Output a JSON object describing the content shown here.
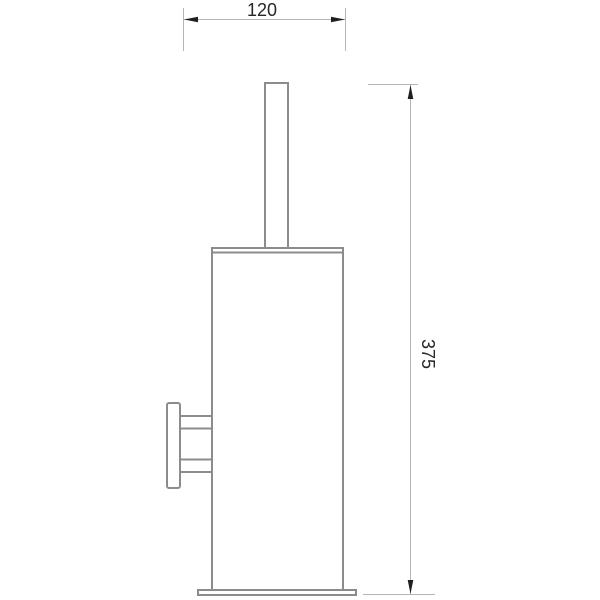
{
  "dimensions": {
    "width_label": "120",
    "height_label": "375"
  },
  "colors": {
    "background": "#ffffff",
    "object_line": "#8c8c8c",
    "dimension_line": "#b5b5b5",
    "arrow": "#1f1f1f",
    "text": "#262626"
  }
}
